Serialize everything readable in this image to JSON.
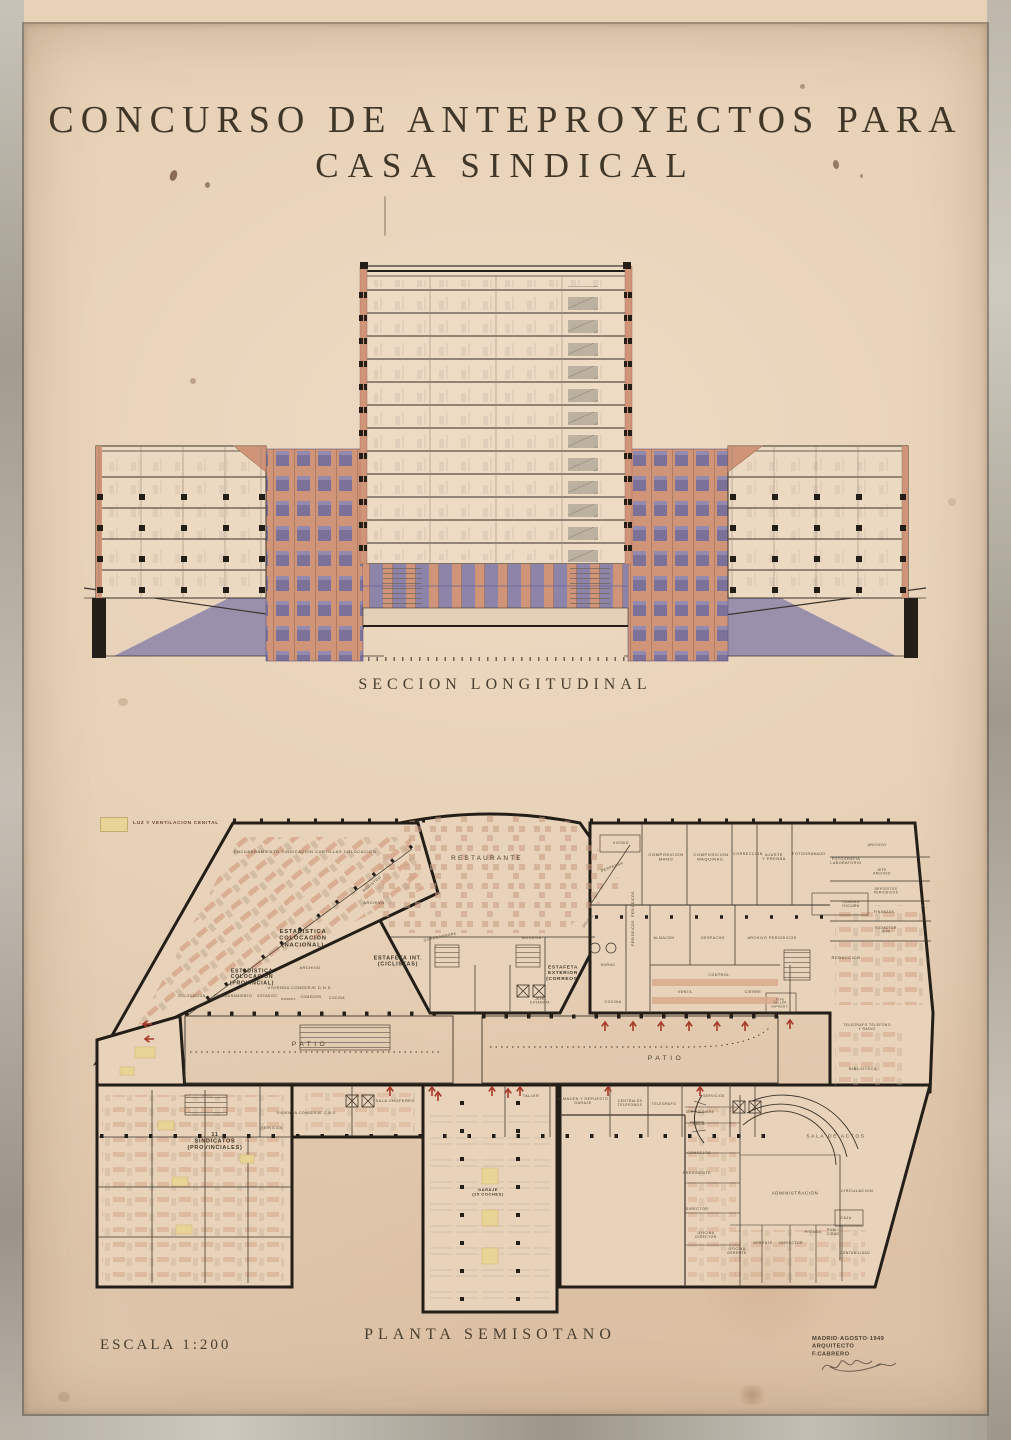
{
  "artwork": {
    "title_line1": "CONCURSO DE ANTEPROYECTOS PARA",
    "title_line2": "CASA SINDICAL",
    "section_caption": "SECCION LONGITUDINAL",
    "plan_caption": "PLANTA SEMISOTANO",
    "scale_label": "ESCALA 1:200",
    "credit_line1": "MADRID·AGOSTO·1949",
    "credit_line2": "ARQUITECTO F.CABRERO",
    "legend_label": "LUZ Y VENTILACION CENITAL",
    "colors": {
      "paper": "#e7d2b8",
      "frame_gray": "#b5afa4",
      "ink": "#3a332b",
      "wall_black": "#241e18",
      "salmon": "#d09478",
      "violet": "#8d84a9",
      "skylight_yellow": "#e8d494",
      "arrow_red": "#a83a28"
    }
  },
  "rooms": {
    "deptRow": "ENCUADRAMIENTO   SINDICACION   CARTILLAS   COLOCACION",
    "registro": "REGISTRO",
    "archivoWing": "ARCHIVO",
    "estadNacional": "ESTADISTICA\nCOLOCACION\n(NACIONAL)",
    "estadProvincial": "ESTADISTICA\nCOLOCACION\n(PROVINCIAL)",
    "archivoEstad": "ARCHIVO",
    "estafetaInt": "ESTAFETA INT.\n(CICLISTAS)",
    "viviendaConserje1": "VIVIENDA CONSERJE   D.N.S.",
    "colocacion": "COLOCACION",
    "encuadramiento": "ENCUADRAMIENTO",
    "estadist": "ESTADIST.",
    "dormit": "DORMIT.",
    "comedor": "COMEDOR",
    "cocina1": "COCINA",
    "restaurante": "RESTAURANTE",
    "guardarropa": "GUARDARROPA",
    "bodega": "BODEGA",
    "oficio": "OFICIO",
    "kiosko": "KIOSKO",
    "despensa": "DESPENSA",
    "composicionMano": "COMPOSICION\nMANO",
    "composicionMaquinas": "COMPOSICION\nMAQUINAS.",
    "correccion": "CORRECCION",
    "ajustePrensa": "AJUSTE\nY PRENSA",
    "fotograbado": "FOTOGRABADO",
    "fotografiaLab": "FOTOGRAFIA\nLABORATORIO",
    "archivoRight": "ARCHIVO",
    "jefeArchivo": "JEFE\nARCHIVO",
    "depositosPeriodicos": "DEPOSITOS\nPERIODICOS",
    "camaraOscura": "CAMARA\nOSCURA",
    "finanzas": "FINANZAS",
    "redactorJefe": "REDACTOR\nJEFE",
    "redaccion": "REDACCION",
    "periodicos": "PERIODICOS",
    "almacen": "ALMACEN",
    "despacho": "DESPACHO",
    "archivoPeriodicos": "ARCHIVO   PERIODICOS",
    "control": "CONTROL",
    "venta": "VENTA",
    "cierre": "CIERRE",
    "jefeTaller": "JEFE\nTALLER\nIMPRENT.",
    "estafetaExt": "ESTAFETA\nEXTERIOR\n(CORREOS)",
    "jefeEstafeta": "JEFE\nESTAFETA",
    "horno": "HORNO",
    "cocina2": "COCINA",
    "patio": "PATIO",
    "salaChoferes": "SALA   CHOFERES",
    "viviendaConserje2": "VIVIENDA   CONSERJE   C.N.S.",
    "servicios": "SERVICIOS",
    "sindicatos": "11\nSINDICATOS\n(PROVINCIALES)",
    "taller": "TALLER",
    "almacenGaraje": "ALMACEN Y REPUESTO\nGARAJE",
    "centralesTelefonos": "CENTRALES\nTELEFONOS",
    "telegrafo": "TELEGRAFO",
    "servidumbre": "SERVIDUMBRE",
    "sala": "SALA",
    "consejos": "CONSEJOS",
    "presidente": "PRESIDENTE",
    "director": "DIRECTOR",
    "oficinaDirector": "OFICINA\nDIRECTOR",
    "oficinaGerente": "OFICINA\nGERENTE",
    "gerente": "GERENTE",
    "inspector": "INSPECTOR",
    "prensa": "PRENSA",
    "publicidad": "PUBLI\nCIDAD",
    "contabilidad": "CONTABILIDAD",
    "salaActos": "SALA   DE   ACTOS",
    "administracion": "ADMINISTRACION",
    "circulacion": "CIRCULACION",
    "caja": "CAJA",
    "garaje": "GARAJE\n(25 COCHES)",
    "biblioteca": "BIBLIOTECA",
    "telegrafoRadio": "TELEGRAFO  TELEFONO\nY RADIO"
  }
}
